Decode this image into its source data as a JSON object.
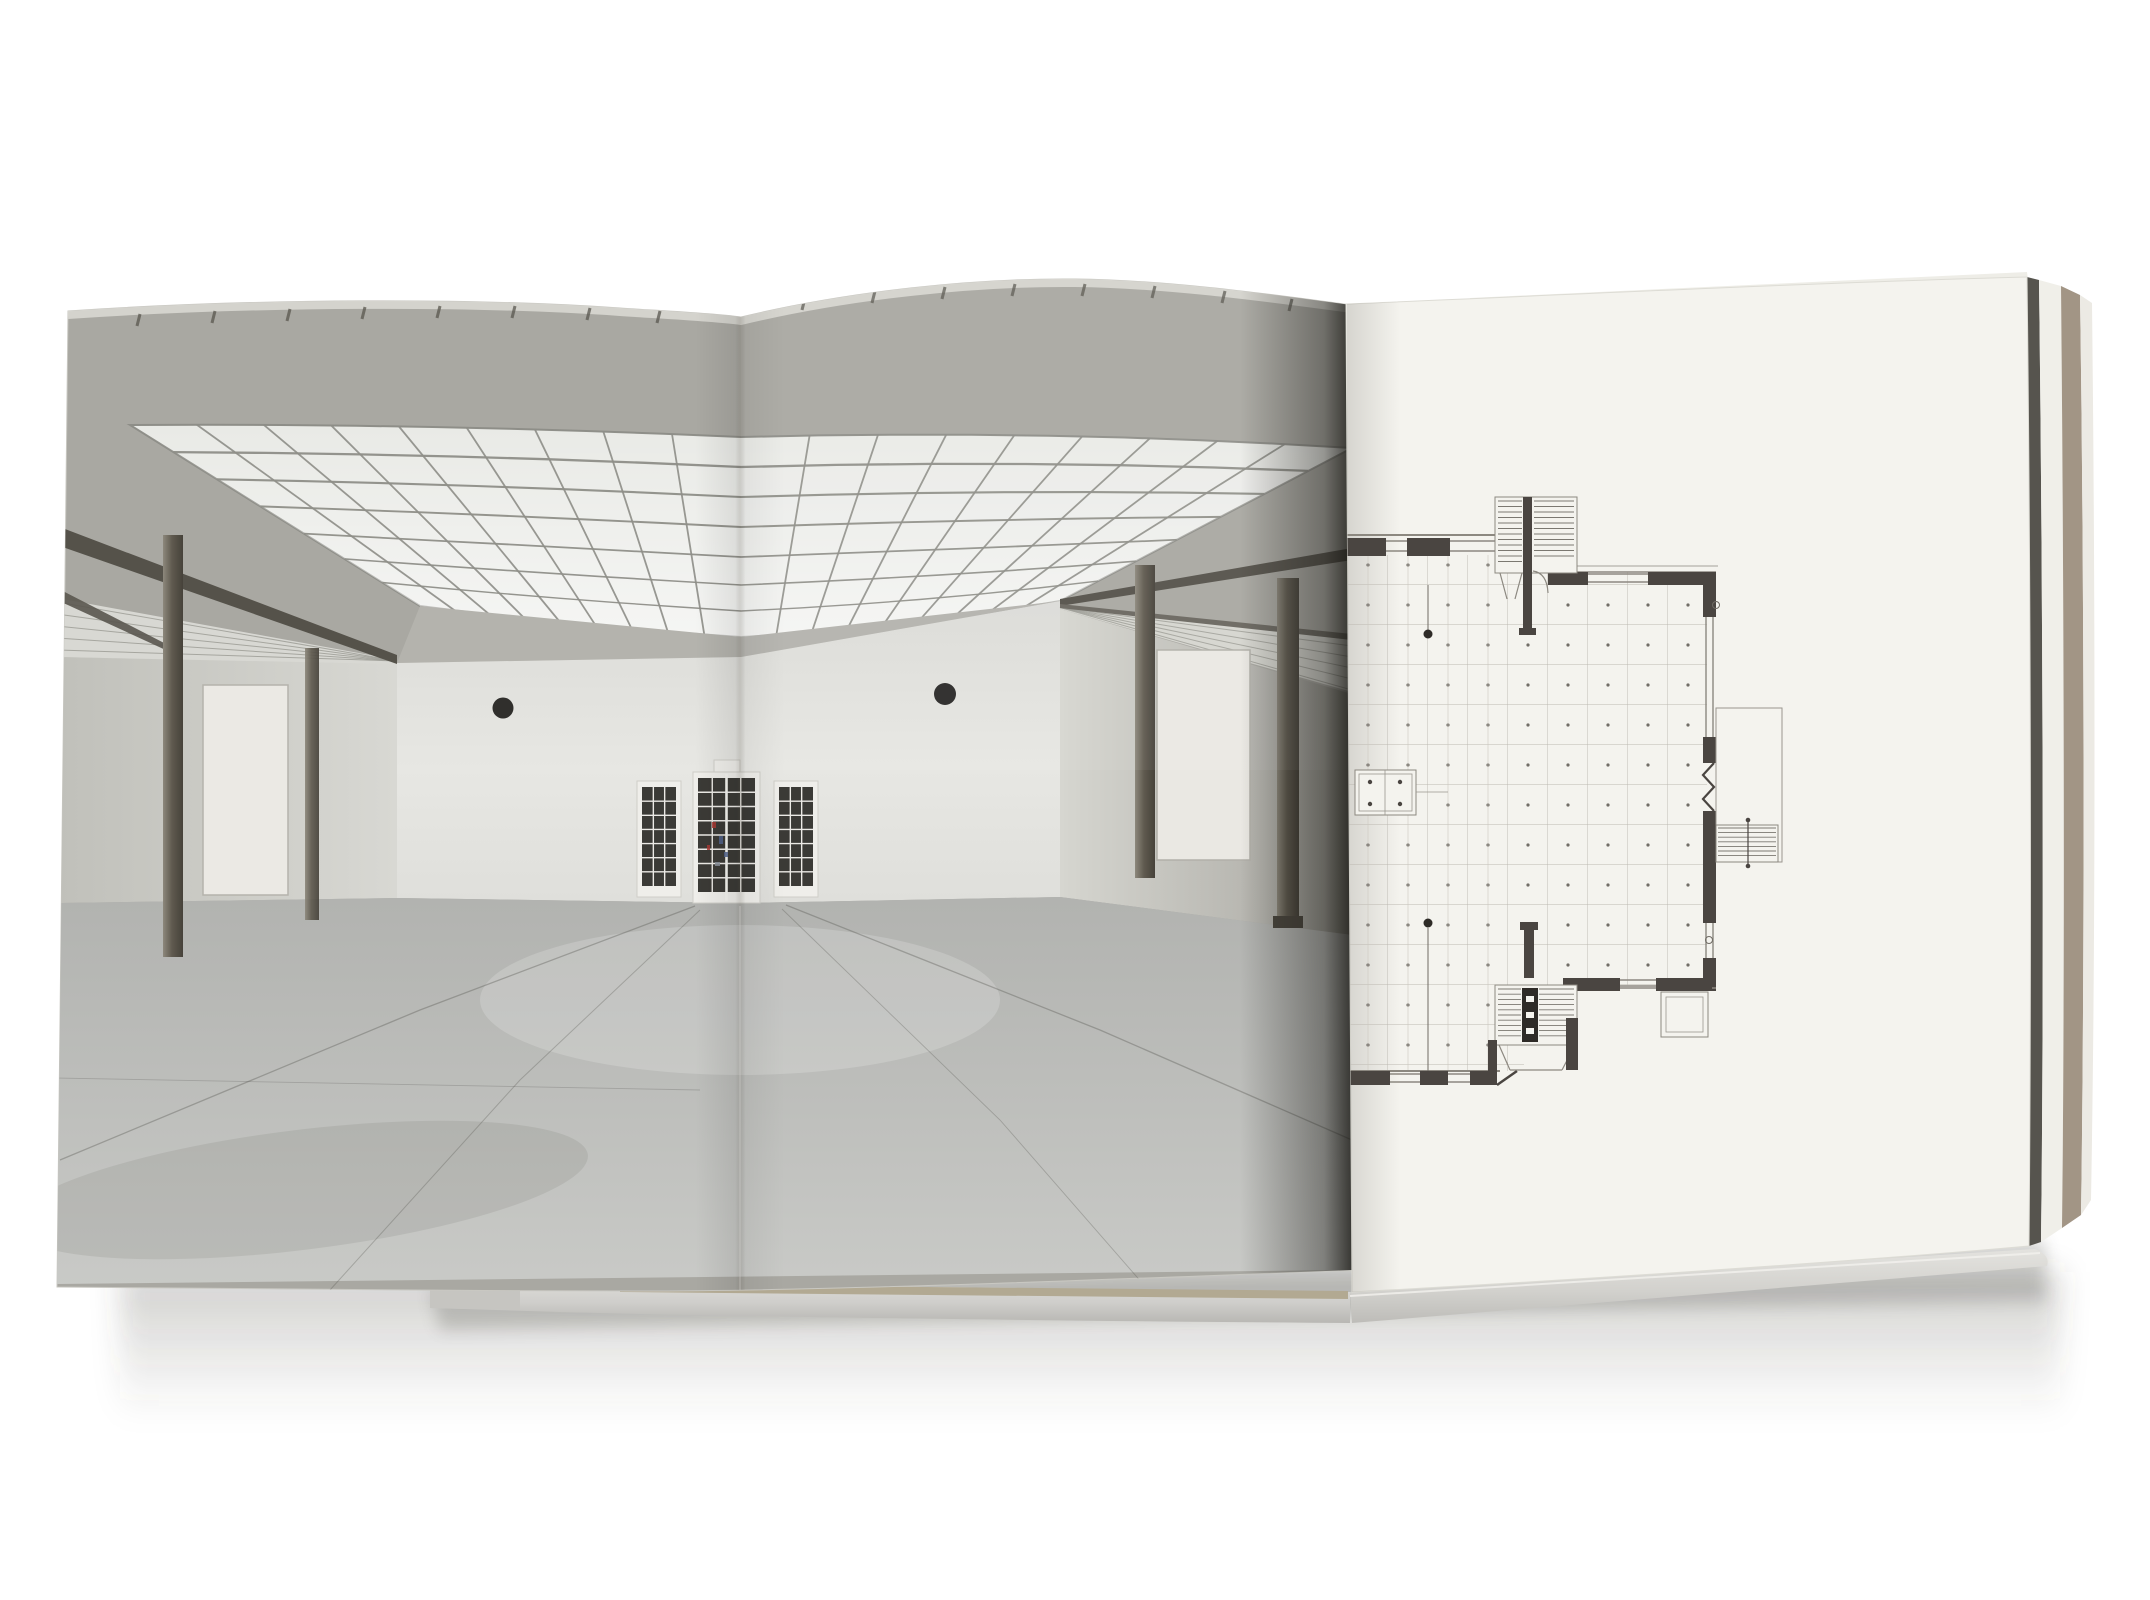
{
  "meta": {
    "domain": "Natural-Image",
    "description": "Product photograph of an open hardcover photobook lying on a white background"
  },
  "book": {
    "spread_alt": "Open photobook spread: panoramic photograph of an empty museum hall on the left pages, architectural floor plan on the recto page",
    "left_page": {
      "content_type": "photograph",
      "alt": "Muted color photograph of an empty gallery hall with a large coffered skylight ceiling, grey cove, slender steel columns, gridded glass doors and a seamed concrete floor"
    },
    "right_page": {
      "content_type": "technical-drawing",
      "alt": "Black ink architectural floor plan with column grid dots, thick stepped walls, three stairs and terrace outline, printed on off-white paper"
    },
    "edges_alt": "Fore-edge of the text block, endpaper line and grey cardboard cover edge visible at the right and bottom of the book",
    "shadow_alt": "Soft drop shadow cast by the book on the white surface"
  },
  "colors": {
    "background": "#ffffff",
    "cove_grey": "#a9a8a2",
    "sky_panel": "#e9eae6",
    "sky_line": "#8e8e88",
    "back_wall": "#e4e4e0",
    "side_wall_left": "#cdcdc7",
    "side_wall_right": "#c9c9c3",
    "floor": "#b9bab7",
    "floor_light": "#cbccc9",
    "beam": "#55524a",
    "column": "#5f5a4f",
    "door_glass": "#3b3a36",
    "door_frame": "#efeeea",
    "speck_red": "#a83832",
    "speck_blue": "#52648c",
    "plan_paper": "#f4f3ee",
    "plan_wall": "#4a4541",
    "plan_thin": "#8c8880",
    "plan_grid": "#bcb8b0",
    "plan_hatch": "#6f6b64",
    "edge_dark": "#56544e",
    "edge_board": "#a29585",
    "edge_white": "#f0efe9",
    "fore_edge_silver": "#d6d5d1",
    "fore_edge_tan": "#b2a992",
    "tick": "#5a574f",
    "top_strip": "#d8d7d2"
  }
}
